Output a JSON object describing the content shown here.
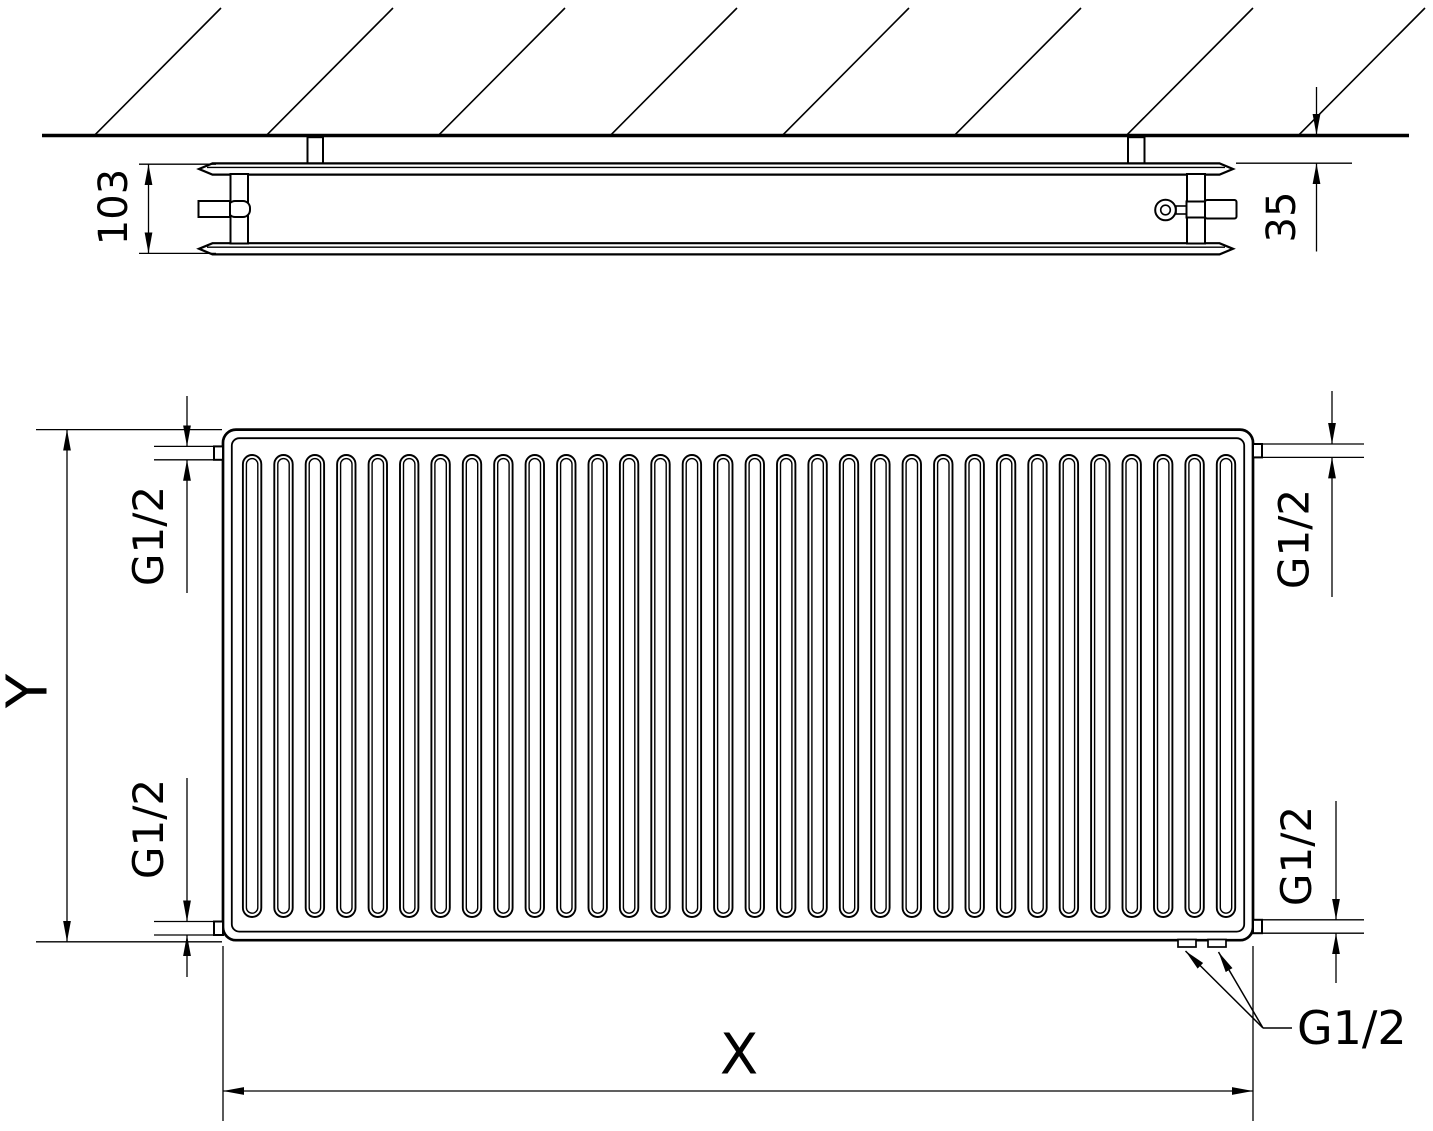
{
  "drawing": {
    "side_view": {
      "depth_dim": "103",
      "wall_distance_dim": "35"
    },
    "front_view": {
      "height_dim": "Y",
      "width_dim": "X",
      "fin_count": 32,
      "connections": {
        "top_left": "G1/2",
        "bottom_left": "G1/2",
        "top_right": "G1/2",
        "bottom_right": "G1/2",
        "bottom_callout": "G1/2"
      }
    },
    "colors": {
      "line": "#000000",
      "background": "#ffffff"
    }
  }
}
